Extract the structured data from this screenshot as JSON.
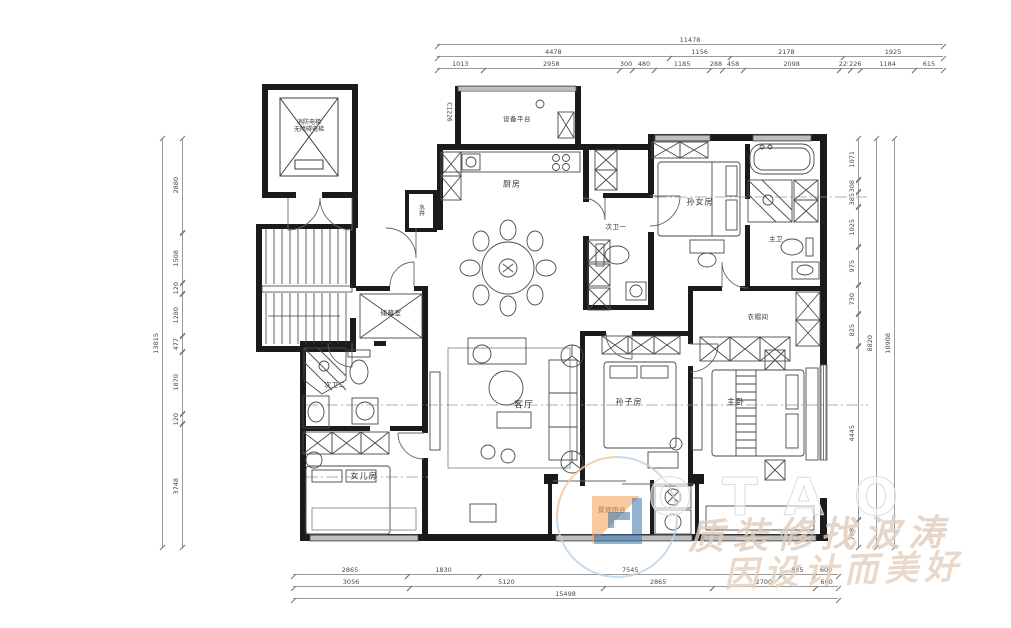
{
  "rooms": {
    "elevator_line1": "消防电梯",
    "elevator_line2": "无障碍电梯",
    "equipment_platform": "设备平台",
    "water_shaft": "水井",
    "kitchen": "厨房",
    "bath1": "次卫一",
    "granddaughter_room": "孙女房",
    "master_bath": "主卫",
    "cloakroom": "衣帽间",
    "storage": "储藏室",
    "living_room": "客厅",
    "grandson_room": "孙子房",
    "master_bedroom": "主卧",
    "bath2": "次卫二",
    "daughter_room": "女儿房",
    "balcony": "景观阳台",
    "window_code": "C1226"
  },
  "dims": {
    "top1": [
      "11478"
    ],
    "top2": [
      "4478",
      "1156",
      "2178",
      "1925"
    ],
    "top3": [
      "1013",
      "2958",
      "300",
      "480",
      "1185",
      "288",
      "458",
      "2098",
      "225",
      "226",
      "1184",
      "615"
    ],
    "bottom1": [
      "2865",
      "1830",
      "7545",
      "845",
      "600"
    ],
    "bottom2": [
      "3056",
      "5120",
      "2865",
      "2700",
      "600"
    ],
    "bottom3": [
      "15498"
    ],
    "left_total": "13815",
    "left": [
      "2880",
      "1508",
      "120",
      "1280",
      "477",
      "1870",
      "120",
      "3748"
    ],
    "right": [
      "1071",
      "308",
      "385",
      "1025",
      "975",
      "730",
      "825",
      "4445",
      "708"
    ],
    "right_mid": "8820",
    "right_total": "10908"
  },
  "watermark": {
    "brand": "OTAO",
    "line1": "质装修找波涛",
    "line2": "因设计而美好"
  },
  "colors": {
    "wall": "#1b1b1b",
    "furniture_line": "#4a4a4a",
    "dim_line": "#9a9a9a",
    "accent_orange": "#f5a65b",
    "accent_blue": "#3874ad"
  }
}
